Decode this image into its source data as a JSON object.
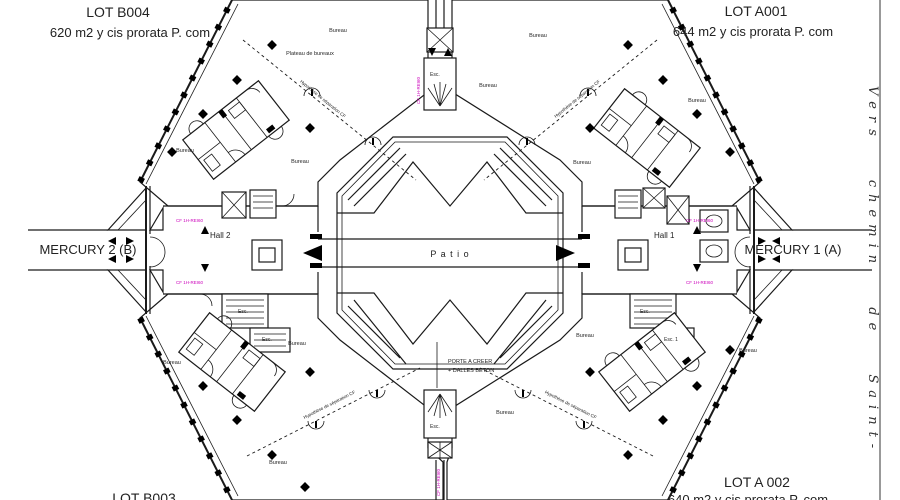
{
  "lots": {
    "b004": {
      "name": "LOT B004",
      "area": "620 m2 y cis prorata P. com"
    },
    "a001": {
      "name": "LOT A001",
      "area": "644 m2 y cis prorata P. com"
    },
    "b003": {
      "name": "LOT B003"
    },
    "a002": {
      "name": "LOT A 002",
      "area": "640 m2 y cis prorata P. com"
    }
  },
  "entrances": {
    "west": "MERCURY 2 (B)",
    "east": "MERCURY 1 (A)"
  },
  "halls": {
    "west": "Hall 2",
    "east": "Hall 1"
  },
  "patio_label": "P a t i o",
  "center_note_line1": "PORTE A CREER",
  "center_note_line2": "+ DALLES BETON",
  "street_label": "Vers chemin de Saint-",
  "room_labels": {
    "bureau": "Bureau",
    "plateau": "Plateau de bureaux",
    "stairs": "Esc.",
    "stairs1": "Esc. 1"
  },
  "annotations": {
    "separation": "Hypothèse de séparation CF",
    "fire": "CF 1H-REI60"
  },
  "colors": {
    "pink": "#f4bdee",
    "blue": "#aad2f2",
    "orange": "#f7d9a2",
    "green": "#b4efbe",
    "line": "#1a1a1a",
    "magenta": "#cc00bb"
  }
}
